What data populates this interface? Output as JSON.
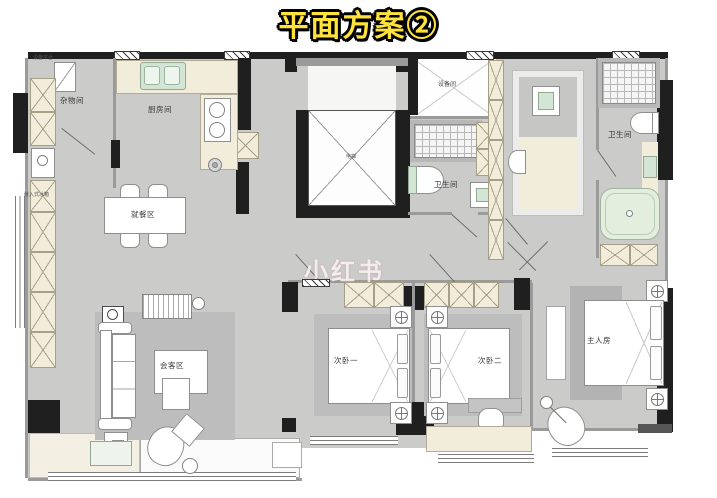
{
  "title": "平面方案②",
  "watermark": "小红书",
  "colors": {
    "title_fill": "#ffe23b",
    "title_outline": "#000000",
    "wall": "#1f1f1f",
    "floor": "#cbcbca",
    "rug": "#bdbdbd",
    "cabinet": "#f2ecdb",
    "fixture_green": "#d3e5d4",
    "bathtub_green": "#e3eedf"
  },
  "labels": {
    "equipment_platform": "设备平台",
    "storage": "杂物间",
    "kitchen": "厨房间",
    "dining": "就餐区",
    "built_in_fridge": "嵌入式冰箱",
    "living": "会客区",
    "elevator": "电梯",
    "equipment_room": "设备间",
    "bathroom_middle": "卫生间",
    "bathroom_master": "卫生间",
    "bedroom_1": "次卧一",
    "bedroom_2": "次卧二",
    "master_bedroom": "主人房"
  }
}
